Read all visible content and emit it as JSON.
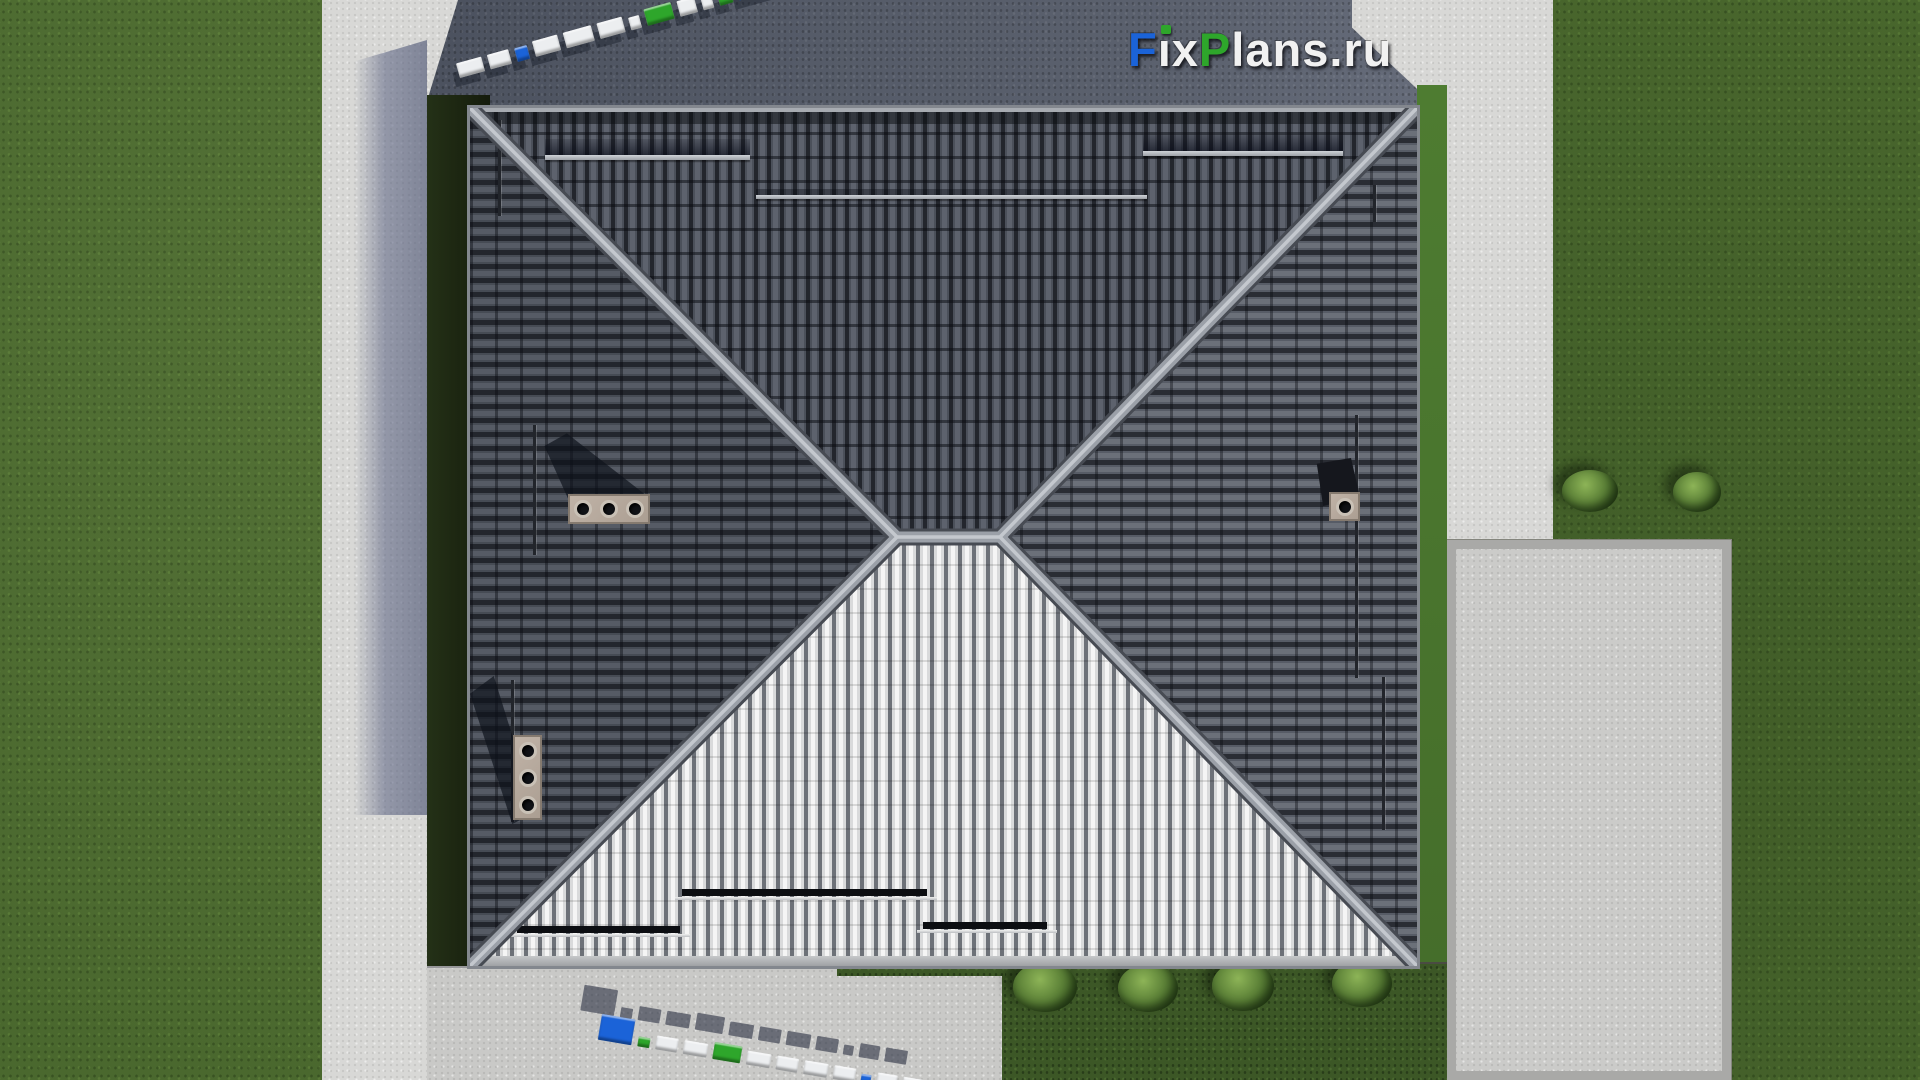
{
  "brand": {
    "logo_text": "FixPlans.ru",
    "logo_parts": {
      "f": "F",
      "i": "ı",
      "x": "x",
      "p": "P",
      "lans": "lans",
      "dot_ru": ".ru"
    },
    "colors": {
      "blue": "#1b63d8",
      "green": "#2ea62b",
      "white": "#eceef0"
    }
  },
  "watermarks": {
    "top": {
      "text": "FixPlans.ru",
      "style": "3d-extruded-blocks-top-view",
      "angle_deg": -15.5,
      "blocks": [
        {
          "w": 26,
          "h": 15,
          "c": "white"
        },
        {
          "w": 22,
          "h": 15,
          "c": "white"
        },
        {
          "w": 13,
          "h": 14,
          "c": "blue"
        },
        {
          "w": 26,
          "h": 16,
          "c": "white"
        },
        {
          "w": 29,
          "h": 16,
          "c": "white"
        },
        {
          "w": 26,
          "h": 16,
          "c": "white"
        },
        {
          "w": 11,
          "h": 13,
          "c": "white"
        },
        {
          "w": 28,
          "h": 17,
          "c": "green"
        },
        {
          "w": 18,
          "h": 16,
          "c": "white"
        },
        {
          "w": 11,
          "h": 16,
          "c": "white"
        },
        {
          "w": 14,
          "h": 12,
          "c": "green"
        },
        {
          "w": 38,
          "h": 28,
          "c": "blue"
        }
      ]
    },
    "bottom": {
      "text": "FixPlans.ru",
      "style": "3d-extruded-blocks-top-view",
      "angle_deg": 9.5,
      "blocks": [
        {
          "w": 34,
          "h": 26,
          "c": "blue"
        },
        {
          "w": 12,
          "h": 10,
          "c": "green"
        },
        {
          "w": 22,
          "h": 14,
          "c": "white"
        },
        {
          "w": 24,
          "h": 14,
          "c": "white"
        },
        {
          "w": 28,
          "h": 17,
          "c": "green"
        },
        {
          "w": 24,
          "h": 14,
          "c": "white"
        },
        {
          "w": 22,
          "h": 14,
          "c": "white"
        },
        {
          "w": 24,
          "h": 14,
          "c": "white"
        },
        {
          "w": 22,
          "h": 14,
          "c": "white"
        },
        {
          "w": 10,
          "h": 10,
          "c": "blue"
        },
        {
          "w": 20,
          "h": 14,
          "c": "white"
        },
        {
          "w": 22,
          "h": 14,
          "c": "white"
        }
      ]
    }
  },
  "scene": {
    "type": "aerial-top-down-render-of-hip-roof-house",
    "roof": {
      "style": "hip-roof-x-ridge",
      "faces": [
        "north-dark-tiles",
        "west-dark-tiles",
        "east-dark-tiles",
        "south-sunlit-tiles"
      ],
      "chimneys": [
        {
          "id": "west-upper",
          "flues": 3,
          "orientation": "horizontal"
        },
        {
          "id": "west-lower",
          "flues": 3,
          "orientation": "vertical"
        },
        {
          "id": "east",
          "flues": 1,
          "orientation": "single"
        }
      ],
      "snow_guards_north": 2,
      "roof_walkway_north": 1,
      "snow_guards_south": 3
    },
    "ground": {
      "lawn_bushes": 2,
      "garden_bushes": 4,
      "palette": {
        "grass": "#4a682e",
        "grass_shadow": "#1b2410",
        "paving_dark": "#555b68",
        "concrete_light": "#d8d8d6",
        "concrete_pad": "#cbcbc9",
        "path_shadow": "#6d7390",
        "roof_dark": "#4b505a",
        "roof_light": "#e8e8e8",
        "ridge": "#9ba0a8",
        "chimney_cap": "#b3a69a"
      }
    }
  }
}
